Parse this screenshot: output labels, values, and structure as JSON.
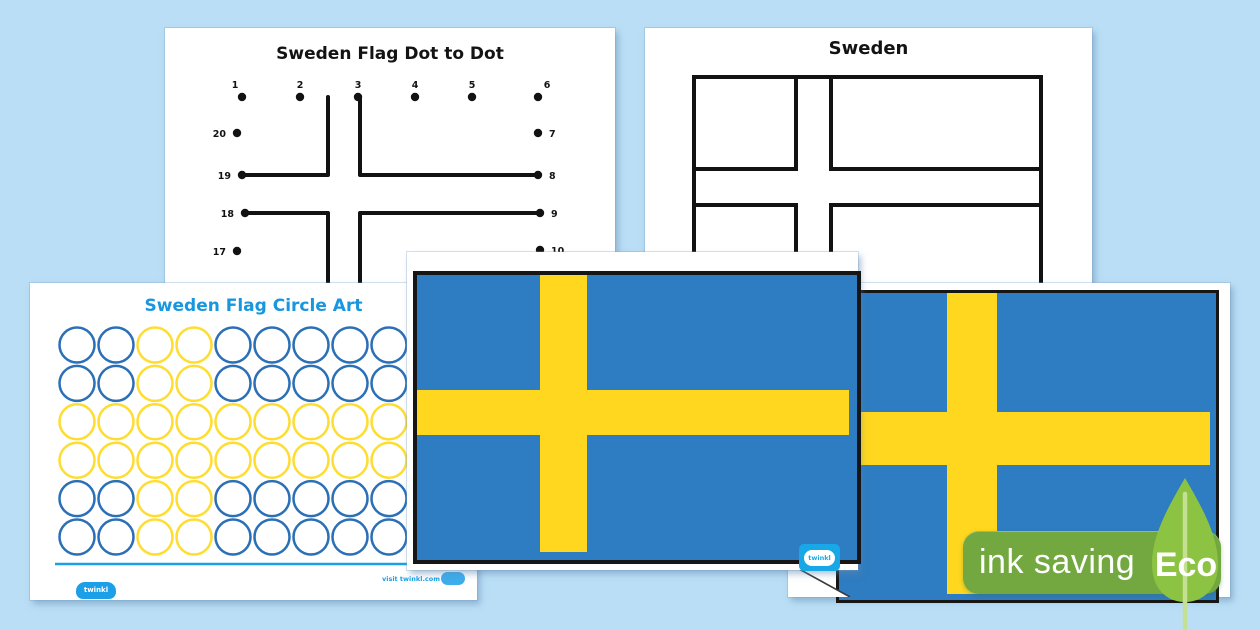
{
  "canvas": {
    "background": "#b9def5"
  },
  "colors": {
    "flag_blue": "#2e7cc1",
    "flag_yellow": "#ffd71f",
    "circle_blue": "#2b6fb7",
    "circle_yellow": "#ffdd30",
    "twinkl_blue": "#1b9fe8",
    "badge_green": "#72a83f",
    "leaf_green": "#8cc342",
    "ink_black": "#121212"
  },
  "pages": {
    "dot_to_dot": {
      "title": "Sweden Flag Dot to Dot",
      "dots": [
        {
          "label": "1",
          "x": 77,
          "y": 69,
          "lx": 70,
          "ly": 60,
          "anchor": "middle"
        },
        {
          "label": "2",
          "x": 135,
          "y": 69,
          "lx": 135,
          "ly": 60,
          "anchor": "middle"
        },
        {
          "label": "3",
          "x": 193,
          "y": 69,
          "lx": 193,
          "ly": 60,
          "anchor": "middle"
        },
        {
          "label": "4",
          "x": 250,
          "y": 69,
          "lx": 250,
          "ly": 60,
          "anchor": "middle"
        },
        {
          "label": "5",
          "x": 307,
          "y": 69,
          "lx": 307,
          "ly": 60,
          "anchor": "middle"
        },
        {
          "label": "6",
          "x": 373,
          "y": 69,
          "lx": 382,
          "ly": 60,
          "anchor": "middle"
        },
        {
          "label": "7",
          "x": 373,
          "y": 105,
          "lx": 384,
          "ly": 109,
          "anchor": "start"
        },
        {
          "label": "8",
          "x": 373,
          "y": 147,
          "lx": 384,
          "ly": 151,
          "anchor": "start"
        },
        {
          "label": "9",
          "x": 375,
          "y": 185,
          "lx": 386,
          "ly": 189,
          "anchor": "start"
        },
        {
          "label": "10",
          "x": 375,
          "y": 222,
          "lx": 386,
          "ly": 226,
          "anchor": "start"
        },
        {
          "label": "17",
          "x": 72,
          "y": 223,
          "lx": 61,
          "ly": 227,
          "anchor": "end"
        },
        {
          "label": "18",
          "x": 80,
          "y": 185,
          "lx": 69,
          "ly": 189,
          "anchor": "end"
        },
        {
          "label": "19",
          "x": 77,
          "y": 147,
          "lx": 66,
          "ly": 151,
          "anchor": "end"
        },
        {
          "label": "20",
          "x": 72,
          "y": 105,
          "lx": 61,
          "ly": 109,
          "anchor": "end"
        }
      ],
      "lines": [
        [
          163,
          69,
          163,
          146
        ],
        [
          195,
          69,
          195,
          146
        ],
        [
          77,
          147,
          163,
          147
        ],
        [
          195,
          147,
          373,
          147
        ],
        [
          80,
          185,
          163,
          185
        ],
        [
          195,
          185,
          375,
          185
        ],
        [
          163,
          186,
          163,
          256
        ],
        [
          195,
          186,
          195,
          256
        ]
      ]
    },
    "outline": {
      "title": "Sweden"
    },
    "circle_art": {
      "title": "Sweden Flag Circle Art",
      "rows": [
        "BBYYBBBBB",
        "BBYYBBBBB",
        "YYYYYYYYY",
        "YYYYYYYYY",
        "BBYYBBBBB",
        "BBYYBBBBB"
      ],
      "grid": {
        "x0": 47,
        "y0": 62,
        "dx": 39,
        "dy": 38.4,
        "r": 17.5
      },
      "logo_label": "twinkl",
      "footer_url": "visit twinkl.com"
    },
    "center_flag": {
      "logo_label": "twinkl"
    },
    "right_flag": {}
  },
  "badge": {
    "label": "ink saving",
    "eco_label": "Eco"
  }
}
